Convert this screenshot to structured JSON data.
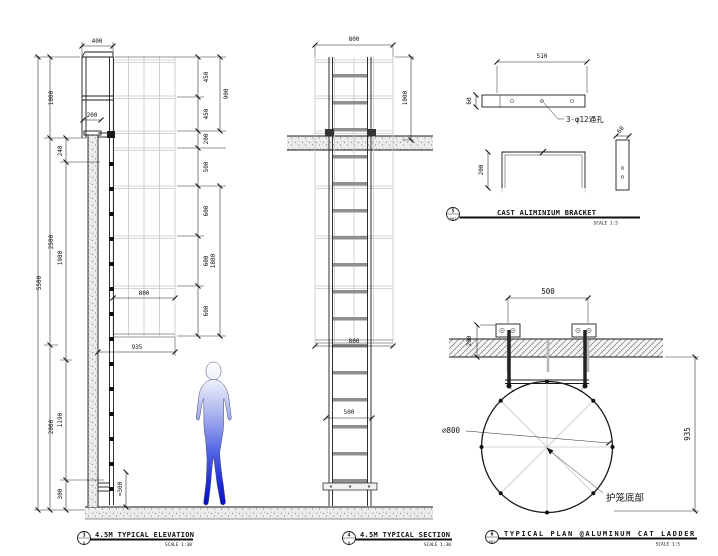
{
  "page": {
    "background": "#ffffff",
    "line_color": "#1a1a1a",
    "cage_color": "#c7c7c7",
    "figure_blue": "#0009b8"
  },
  "views": {
    "elevation": {
      "ref_num": "3",
      "ref_sheet": "0",
      "title": "4.5M TYPICAL ELEVATION",
      "scale": "SCALE 1:30",
      "dims": {
        "top_width": "400",
        "top_offset": "200",
        "total_height": "5500",
        "seg_top": "1000",
        "seg_mid": "2500",
        "seg_bottom": "2000",
        "parapet": "240",
        "wall_upper": "1980",
        "wall_mid": "1190",
        "wall_base": "300",
        "cage_top1": "450",
        "cage_top2": "450",
        "cage_top_total": "900",
        "cage_gap": "200",
        "hoop_first": "500",
        "hoop_a": "600",
        "hoop_b": "600",
        "hoop_c": "600",
        "hoop_total": "1800",
        "cage_width": "800",
        "cage_offset": "935",
        "bottom_rung": "≈300"
      }
    },
    "section": {
      "ref_num": "4",
      "ref_sheet": "0",
      "title": "4.5M TYPICAL SECTION",
      "scale": "SCALE 1:30",
      "dims": {
        "cage_width_top": "800",
        "above_slab": "1000",
        "cage_width_bottom": "800",
        "ladder_width": "500"
      }
    },
    "bracket": {
      "ref_num": "5",
      "ref_sheet": "001",
      "title": "CAST ALIMINIUM BRACKET",
      "scale": "SCALE 1:5",
      "note": "3-φ12通孔",
      "dims": {
        "length": "510",
        "bar_depth": "60",
        "height": "200",
        "side_width": "60"
      }
    },
    "plan": {
      "ref_num": "6",
      "ref_sheet": "001",
      "title": "TYPICAL PLAN @ALUMINUM CAT LADDER",
      "scale": "SCALE 1:5",
      "label_cage_bottom": "护笼底部",
      "dims": {
        "bracket_spacing": "500",
        "wall_thickness": "200",
        "drop_height": "935",
        "cage_diameter": "∅800"
      }
    }
  }
}
